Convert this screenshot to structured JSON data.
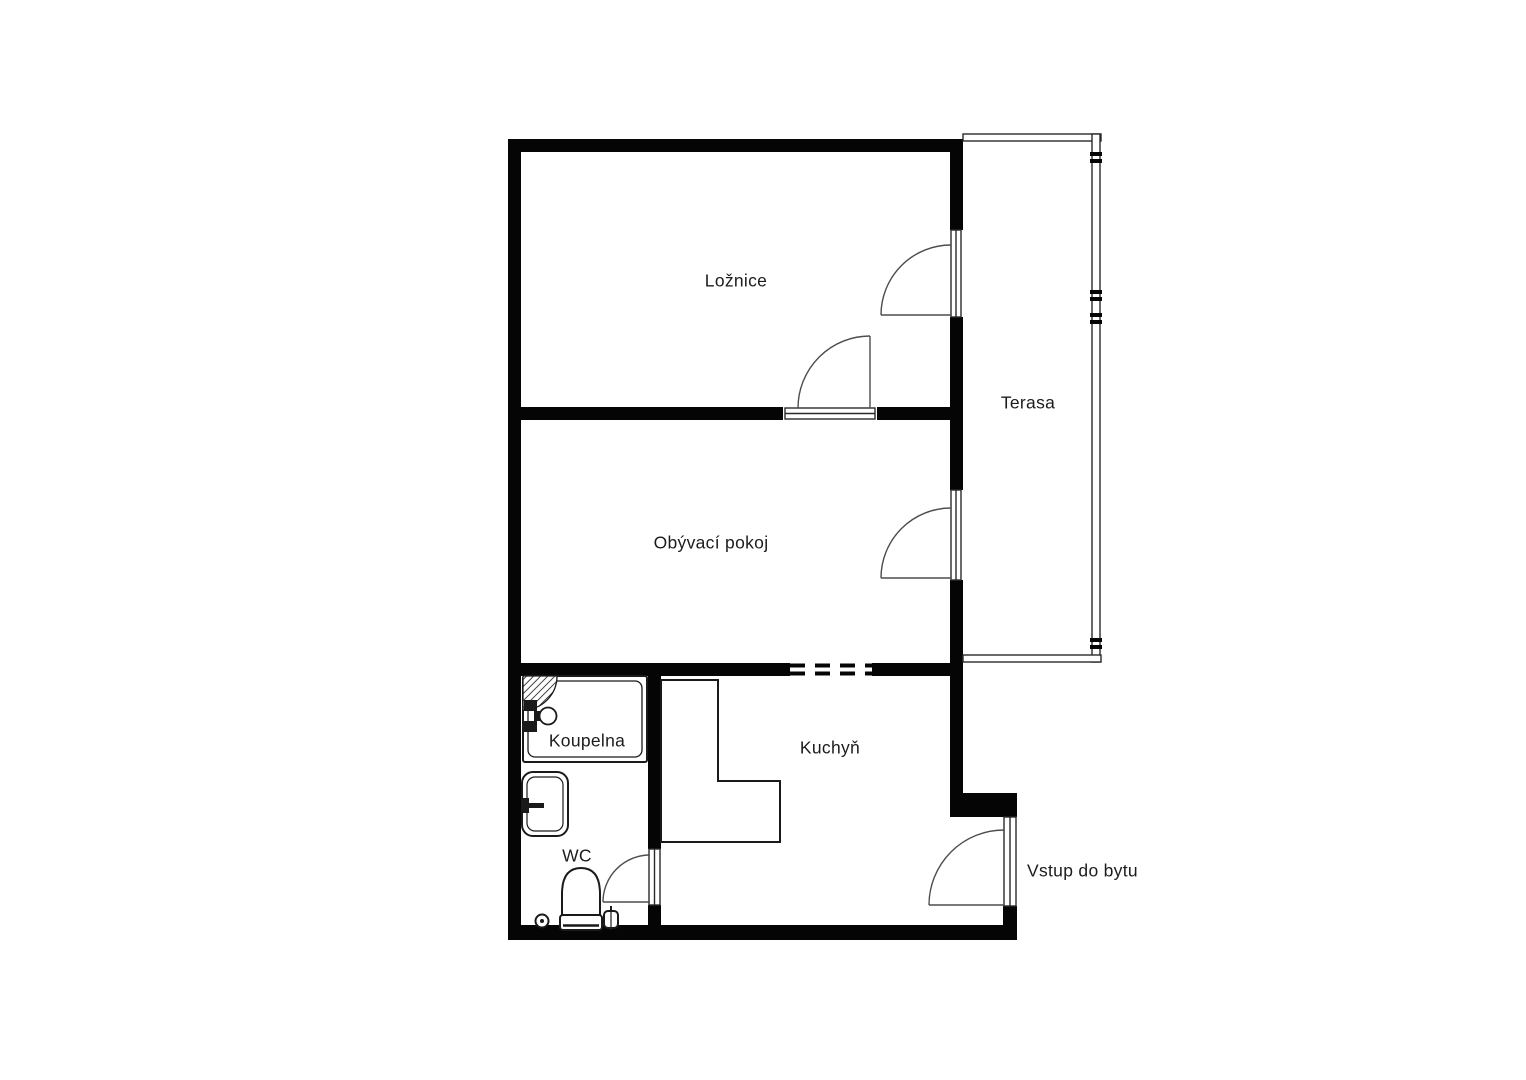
{
  "rooms": {
    "loznice": "Ložnice",
    "terasa": "Terasa",
    "obyvaci_pokoj": "Obývací pokoj",
    "koupelna": "Koupelna",
    "kuchyn": "Kuchyň",
    "wc": "WC"
  },
  "annotations": {
    "entrance": "Vstup do bytu"
  },
  "colors": {
    "wall": "#050505",
    "thin_line": "#2a2a2a",
    "door_line": "#4d4d4d",
    "text": "#1c1c1c",
    "background": "#ffffff"
  }
}
